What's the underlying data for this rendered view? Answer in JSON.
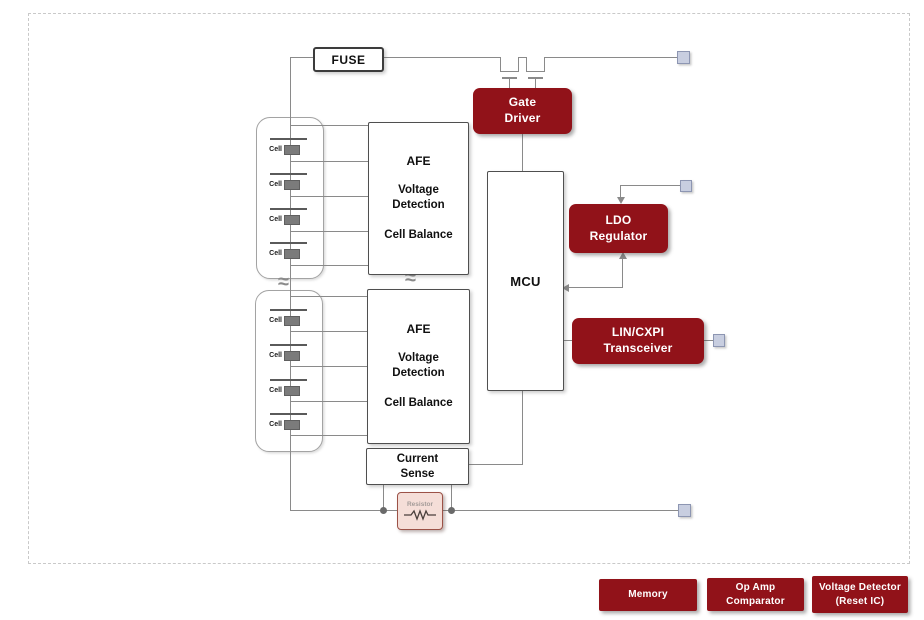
{
  "colors": {
    "block_red": "#911219",
    "wire_gray": "#8a8a8a",
    "connector_fill": "#c8cee0",
    "connector_border": "#8d96b2",
    "resistor_fill": "#f5ded8",
    "resistor_border": "#9c5247"
  },
  "fuse": {
    "label": "FUSE"
  },
  "stacks": [
    {
      "cells": [
        "Cell",
        "Cell",
        "Cell",
        "Cell"
      ]
    },
    {
      "cells": [
        "Cell",
        "Cell",
        "Cell",
        "Cell"
      ]
    }
  ],
  "afe_blocks": [
    {
      "title": "AFE",
      "functions": [
        "Voltage Detection",
        "Cell Balance"
      ]
    },
    {
      "title": "AFE",
      "functions": [
        "Voltage Detection",
        "Cell Balance"
      ]
    }
  ],
  "mcu": {
    "label": "MCU"
  },
  "gate_driver": {
    "lines": [
      "Gate",
      "Driver"
    ]
  },
  "ldo_regulator": {
    "lines": [
      "LDO",
      "Regulator"
    ]
  },
  "lin_transceiver": {
    "lines": [
      "LIN/CXPI",
      "Transceiver"
    ]
  },
  "current_sense": {
    "lines": [
      "Current",
      "Sense"
    ]
  },
  "resistor": {
    "label": "Resistor"
  },
  "legend": [
    {
      "lines": [
        "Memory"
      ]
    },
    {
      "lines": [
        "Op Amp",
        "Comparator"
      ]
    },
    {
      "lines": [
        "Voltage Detector",
        "(Reset IC)"
      ]
    }
  ],
  "symbols": [
    "break-squiggle",
    "mosfet",
    "junction-dot",
    "connector-pad",
    "resistor-zigzag"
  ]
}
